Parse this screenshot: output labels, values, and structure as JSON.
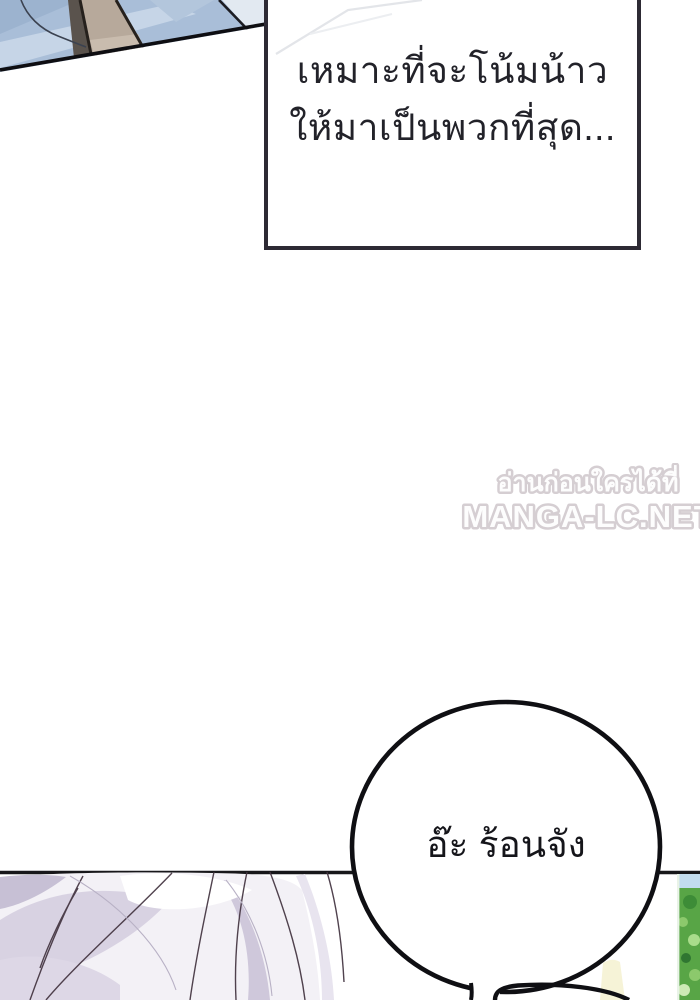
{
  "comic_page": {
    "narration_box": {
      "lines": [
        "เหมาะที่จะโน้มน้าว",
        "ให้มาเป็นพวกที่สุด..."
      ],
      "border_color": "#2d2a34",
      "text_color": "#222229"
    },
    "watermark": {
      "tagline_thai": "อ่านก่อนใครได้ที่",
      "site_name": "MANGA-LC.NET",
      "color": "#d3ccd0"
    },
    "speech_bubble": {
      "text": "อ๊ะ ร้อนจัง",
      "outline_color": "#0f0f13",
      "text_color": "#15151a"
    },
    "art": {
      "top_left_panel": "blue fabric clothing close-up with tan strap",
      "bottom_left_panel": "silver-lavender hair crown",
      "bottom_right_panel": "green foliage with sky sliver",
      "colors": {
        "fabric_blue": "#a9bed8",
        "fabric_blue_light": "#c6d5e7",
        "strap_tan": "#b7a99b",
        "strap_dark": "#5a534d",
        "hair_base": "#f3f1f6",
        "hair_shade": "#d5cee0",
        "hair_strand_line": "#42333f",
        "foliage_green": "#58a546",
        "sky_blue": "#c2dcee",
        "sunlight_pale": "#f6f3d7",
        "panel_line": "#17171a"
      }
    }
  }
}
